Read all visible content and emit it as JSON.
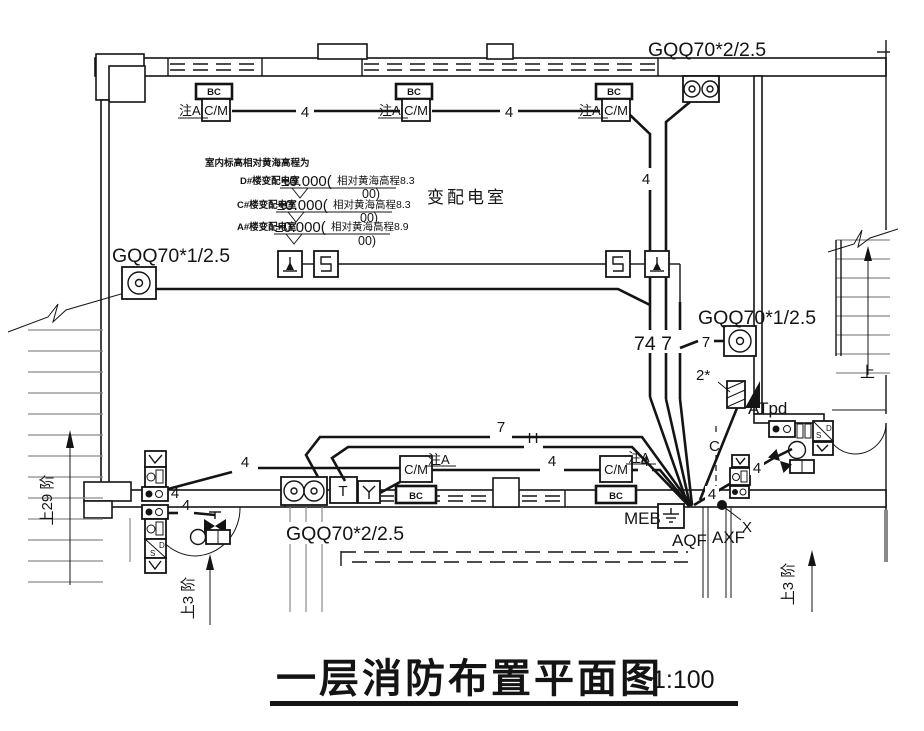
{
  "meta": {
    "bg": "#ffffff",
    "ink": "#141414",
    "gray": "#8a8a8a"
  },
  "title": {
    "text": "一层消防布置平面图",
    "scale": "1:100"
  },
  "room": {
    "name": "变配电室"
  },
  "cable_labels": {
    "top": "GQQ70*2/2.5",
    "left": "GQQ70*1/2.5",
    "mid_right": "GQQ70*1/2.5",
    "bottom": "GQQ70*2/2.5"
  },
  "elevation_note": {
    "heading": "室内标高相对黄海高程为",
    "rows": [
      {
        "building": "D#楼变配电室",
        "value": "±0.000(",
        "datum": "相对黄海高程8.3",
        "cont": "00)"
      },
      {
        "building": "C#楼变配电室",
        "value": "±0.000(",
        "datum": "相对黄海高程8.3",
        "cont": "00)"
      },
      {
        "building": "A#楼变配电室",
        "value": "±0.000(",
        "datum": "相对黄海高程8.9",
        "cont": "00)"
      }
    ]
  },
  "devices": {
    "bc": "BC",
    "cm": "C/M",
    "note_a": "注A",
    "t": "T",
    "s": "S",
    "d": "D"
  },
  "panels": {
    "atpd": "ATpd",
    "meb": "MEB",
    "aqf": "AQF",
    "axf": "AXF",
    "x": "X",
    "c": "C",
    "two_star": "2*"
  },
  "wire_counts": {
    "four": "4",
    "seven": "7",
    "h": "H",
    "bundle": "74 7"
  },
  "stairs": {
    "left": "上29 阶",
    "bottom_left": "上3 阶",
    "bottom_right": "上3 阶",
    "up": "上"
  }
}
